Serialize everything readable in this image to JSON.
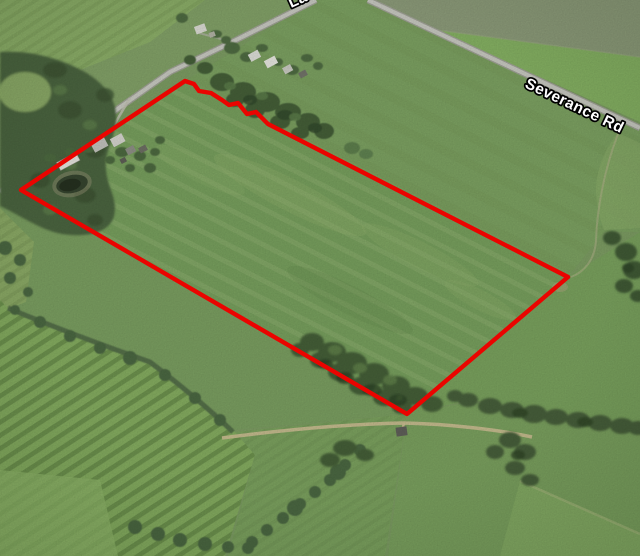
{
  "map": {
    "labels": {
      "road_right": "Severance Rd",
      "road_top_partial": "La"
    },
    "colors": {
      "parcel_boundary": "#ea0400",
      "road_fill": "#c9cac2",
      "label_text": "#ffffff",
      "label_outline": "#000000",
      "field_green": "#7d9d63",
      "forest_green": "#4b6540",
      "dirt_track": "#cdbf94"
    }
  }
}
